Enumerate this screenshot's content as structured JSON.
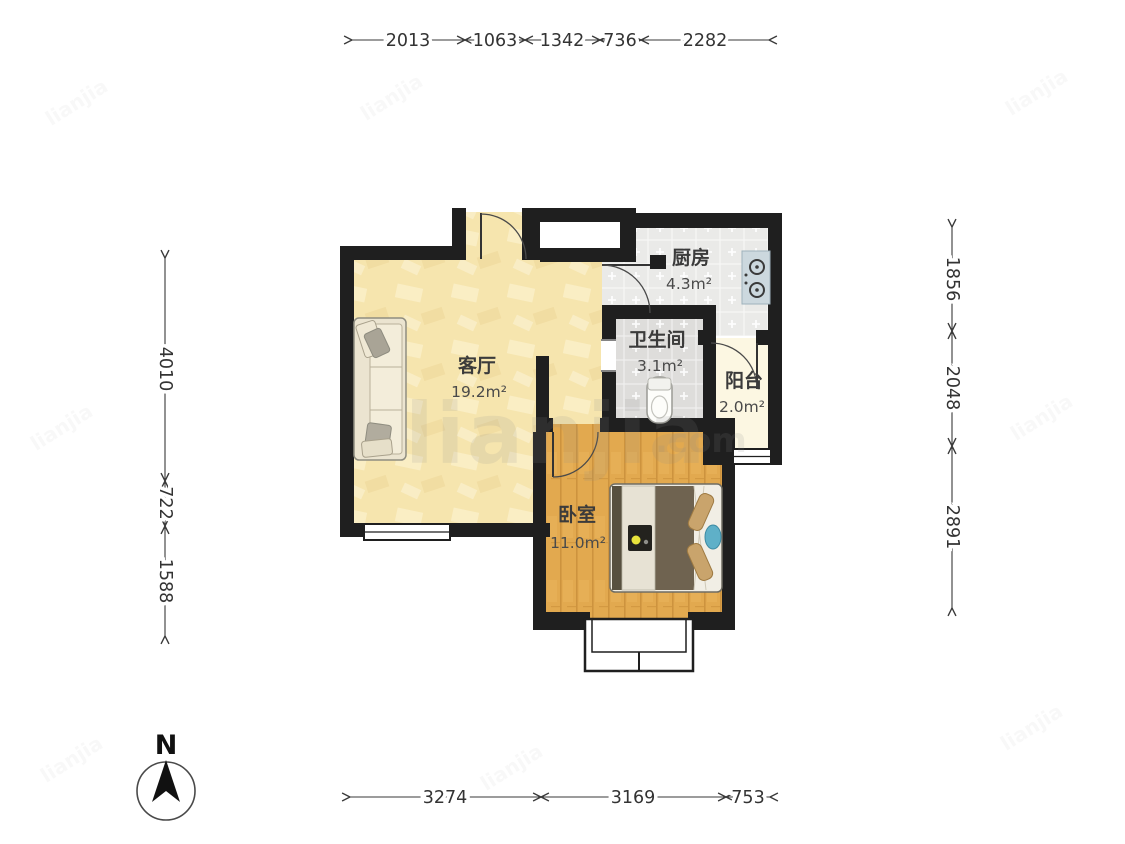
{
  "rooms": {
    "living": {
      "name": "客厅",
      "area": "19.2m²"
    },
    "kitchen": {
      "name": "厨房",
      "area": "4.3m²"
    },
    "bathroom": {
      "name": "卫生间",
      "area": "3.1m²"
    },
    "balcony": {
      "name": "阳台",
      "area": "2.0m²"
    },
    "bedroom": {
      "name": "卧室",
      "area": "11.0m²"
    }
  },
  "dimensions": {
    "top": [
      "2013",
      "1063",
      "1342",
      "736",
      "2282"
    ],
    "left": [
      "4010",
      "722",
      "1588"
    ],
    "right": [
      "1856",
      "2048",
      "2891"
    ],
    "bottom": [
      "3274",
      "3169",
      "753"
    ]
  },
  "compass": {
    "label": "N"
  },
  "watermark": {
    "main": "lianjia",
    "suffix": ".com"
  },
  "colors": {
    "wall": "#1f1f1f",
    "living_floor": "#f6e5ae",
    "bedroom_floor": "#e2a94f",
    "kitchen_floor": "#eaeae8",
    "bathroom_floor": "#dedddb",
    "balcony_floor": "#fcf7e2",
    "dimension_text": "#333333"
  }
}
